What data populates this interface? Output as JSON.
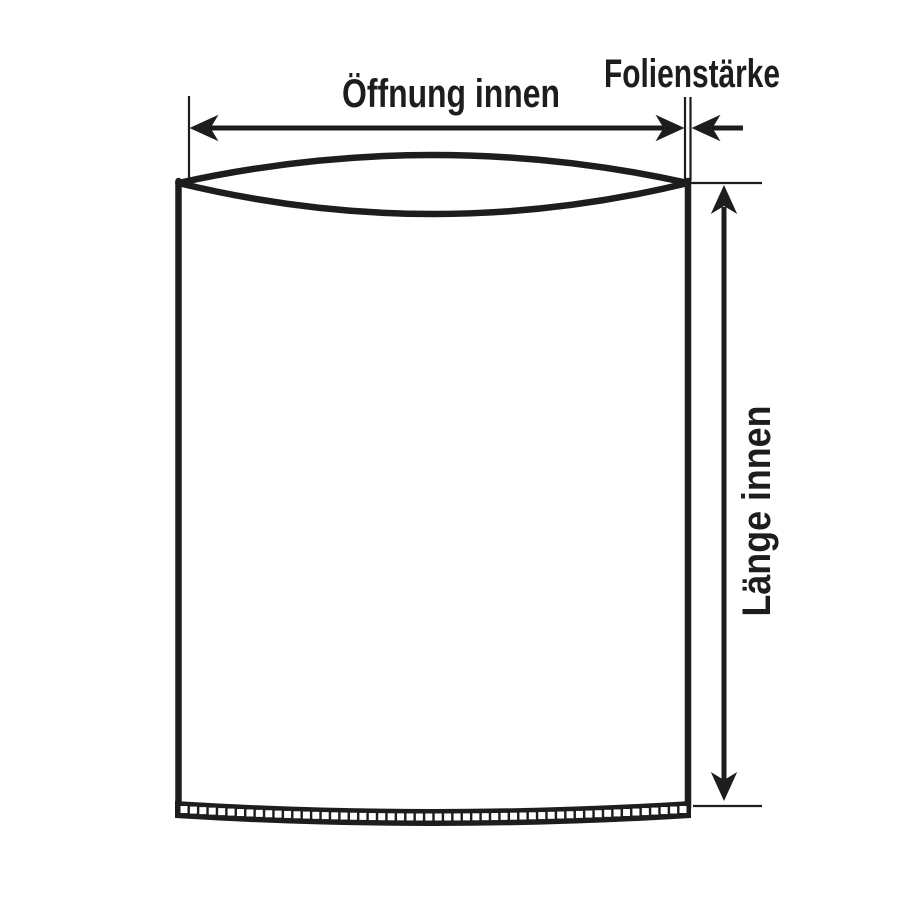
{
  "diagram": {
    "labels": {
      "opening_width": "Öffnung innen",
      "film_thickness": "Folienstärke",
      "inner_length": "Länge innen"
    },
    "colors": {
      "line": "#1d1d1b",
      "background": "#ffffff"
    },
    "seam": {
      "square_count": 54
    }
  }
}
